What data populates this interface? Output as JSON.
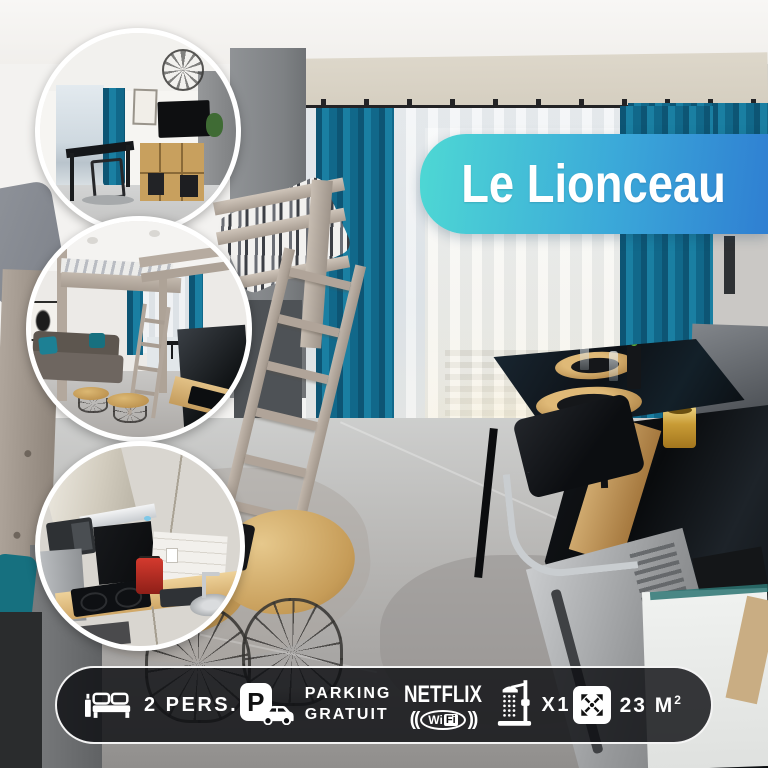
{
  "title": "Le Lionceau",
  "theme": {
    "banner_gradient_start": "#4ed8d4",
    "banner_gradient_end": "#2f7fd2",
    "curtain_teal": "#1a7fa2",
    "bar_background": "rgba(14,15,18,0.82)",
    "bar_border": "#ffffff",
    "text_color": "#ffffff"
  },
  "photos": {
    "main_label": "Studio apartment with loft bed, teal curtains, dining table and black kitchen bar",
    "insets": [
      {
        "label": "Living area with TV, wooden shelf and dining table"
      },
      {
        "label": "Loft bed above sofa with round side tables"
      },
      {
        "label": "Kitchenette with induction hob, coffee machine and sink"
      }
    ]
  },
  "amenities": {
    "capacity": {
      "icon": "bed-icon",
      "label": "2 PERS."
    },
    "parking": {
      "icon": "parking-icon",
      "badge": "P",
      "line1": "PARKING",
      "line2": "GRATUIT"
    },
    "wifi_netflix": {
      "icon": "wifi-icon",
      "brand": "NETFLIX",
      "paren_left": "((",
      "wifi_part1": "Wi",
      "wifi_part2": "Fi",
      "paren_right": "))"
    },
    "shower": {
      "icon": "shower-icon",
      "label": "X1"
    },
    "area": {
      "icon": "expand-arrows-icon",
      "label": "23 M",
      "superscript": "2"
    }
  }
}
